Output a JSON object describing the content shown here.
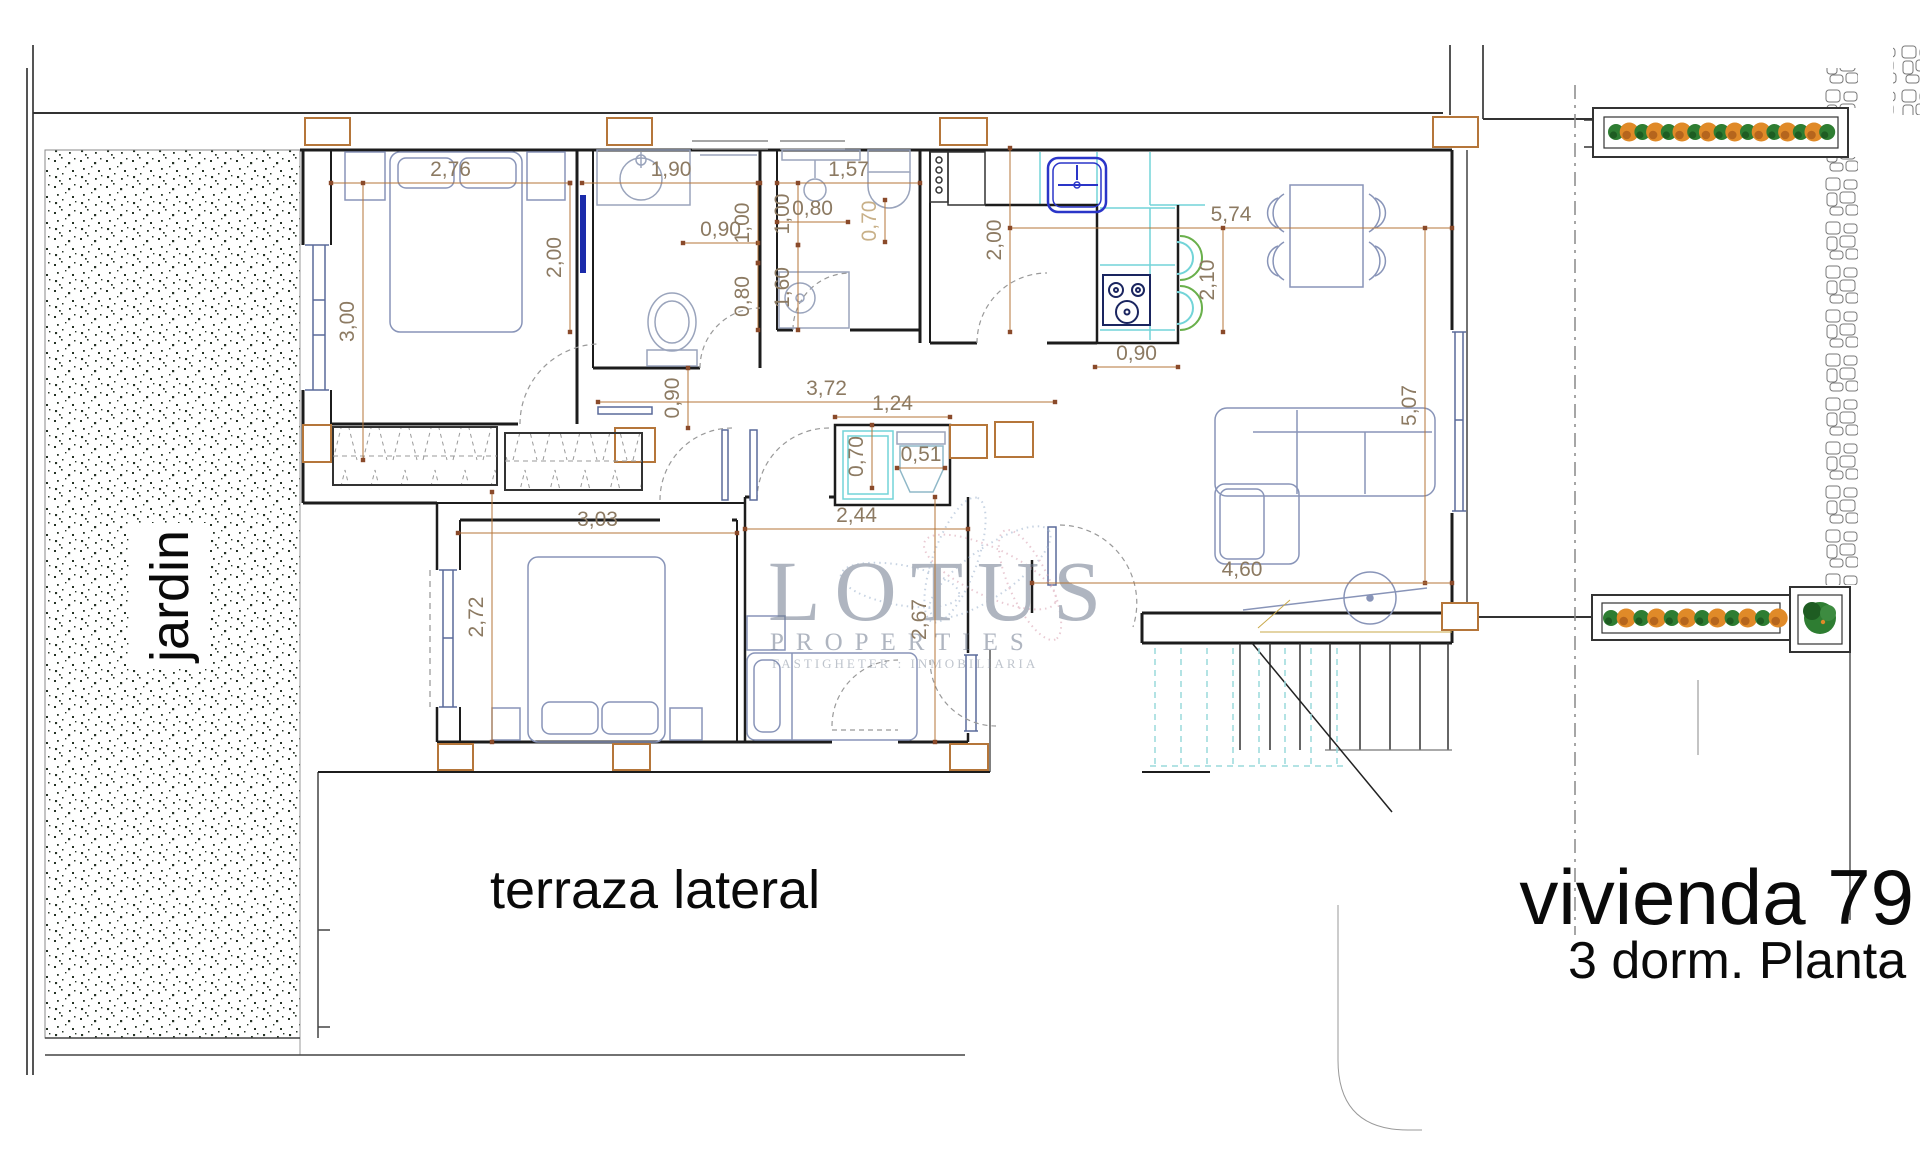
{
  "title": {
    "name": "vivienda 79",
    "subtitle": "3 dorm.  Planta Baja"
  },
  "labels": {
    "garden": "jardin",
    "terrace": "terraza lateral"
  },
  "watermark": {
    "brand": "LOTUS",
    "sub": "PROPERTIES",
    "tagline": "FASTIGHETER : INMOBILIARIA"
  },
  "colors": {
    "dim_line": "#b5763a",
    "dim_tick": "#8a4a2a",
    "dim_text": "#8c7a62",
    "dim_text_light": "#c8b088",
    "wall": "#1c1c1c",
    "furniture": "#8894b8",
    "fixture": "#9aa4bc",
    "counter_cyan": "#72d4d8",
    "sink_blue": "#2a35c8",
    "stove_navy": "#1a2560",
    "chair_green": "#6ab04c",
    "plant_green": "#2e7d32",
    "plant_green_dark": "#1e5c22",
    "plant_orange": "#e08a28",
    "plant_orange_dark": "#b5651d",
    "column_orange": "#b5763a",
    "stairs_cyan": "#9adadc",
    "watermark_gray": "#6e7a8e"
  },
  "dimensions": [
    {
      "value": "2,76",
      "o": "h",
      "x1": 331,
      "x2": 570,
      "y": 183
    },
    {
      "value": "3,00",
      "o": "v",
      "x": 363,
      "y1": 183,
      "y2": 460
    },
    {
      "value": "2,00",
      "o": "v",
      "x": 570,
      "y1": 183,
      "y2": 332
    },
    {
      "value": "1,90",
      "o": "h",
      "x1": 582,
      "x2": 760,
      "y": 183
    },
    {
      "value": "0,90",
      "o": "h",
      "x1": 683,
      "x2": 758,
      "y": 243
    },
    {
      "value": "1,00",
      "o": "v",
      "x": 758,
      "y1": 183,
      "y2": 263
    },
    {
      "value": "0,80",
      "o": "v",
      "x": 758,
      "y1": 263,
      "y2": 330
    },
    {
      "value": "1,57",
      "o": "h",
      "x1": 777,
      "x2": 920,
      "y": 183
    },
    {
      "value": "1,00",
      "o": "v",
      "x": 798,
      "y1": 183,
      "y2": 245
    },
    {
      "value": "0,80",
      "o": "h",
      "x1": 777,
      "x2": 848,
      "y": 222
    },
    {
      "value": "0,70",
      "o": "v",
      "x": 885,
      "y1": 200,
      "y2": 242,
      "light": true
    },
    {
      "value": "1,60",
      "o": "v",
      "x": 798,
      "y1": 245,
      "y2": 330
    },
    {
      "value": "2,00",
      "o": "v",
      "x": 1010,
      "y1": 148,
      "y2": 332
    },
    {
      "value": "5,74",
      "o": "h",
      "x1": 1010,
      "x2": 1452,
      "y": 228
    },
    {
      "value": "2,10",
      "o": "v",
      "x": 1223,
      "y1": 228,
      "y2": 332
    },
    {
      "value": "0,90",
      "o": "h",
      "x1": 1095,
      "x2": 1178,
      "y": 367
    },
    {
      "value": "5,07",
      "o": "v",
      "x": 1425,
      "y1": 228,
      "y2": 583
    },
    {
      "value": "3,72",
      "o": "h",
      "x1": 598,
      "x2": 1055,
      "y": 402
    },
    {
      "value": "0,90",
      "o": "v",
      "x": 688,
      "y1": 368,
      "y2": 428
    },
    {
      "value": "1,24",
      "o": "h",
      "x1": 835,
      "x2": 950,
      "y": 417
    },
    {
      "value": "0,70",
      "o": "v",
      "x": 872,
      "y1": 425,
      "y2": 488
    },
    {
      "value": "0,51",
      "o": "h",
      "x1": 897,
      "x2": 945,
      "y": 468
    },
    {
      "value": "2,44",
      "o": "h",
      "x1": 745,
      "x2": 968,
      "y": 529
    },
    {
      "value": "3,03",
      "o": "h",
      "x1": 458,
      "x2": 737,
      "y": 533
    },
    {
      "value": "2,72",
      "o": "v",
      "x": 492,
      "y1": 492,
      "y2": 742
    },
    {
      "value": "2,67",
      "o": "v",
      "x": 935,
      "y1": 497,
      "y2": 742
    },
    {
      "value": "4,60",
      "o": "h",
      "x1": 1032,
      "x2": 1452,
      "y": 583
    }
  ],
  "planters": {
    "top": {
      "count": 17,
      "x_start": 1616,
      "step": 13.2,
      "y": 132
    },
    "side": {
      "count": 12,
      "x_start": 1611,
      "step": 15.2,
      "y": 618
    }
  }
}
